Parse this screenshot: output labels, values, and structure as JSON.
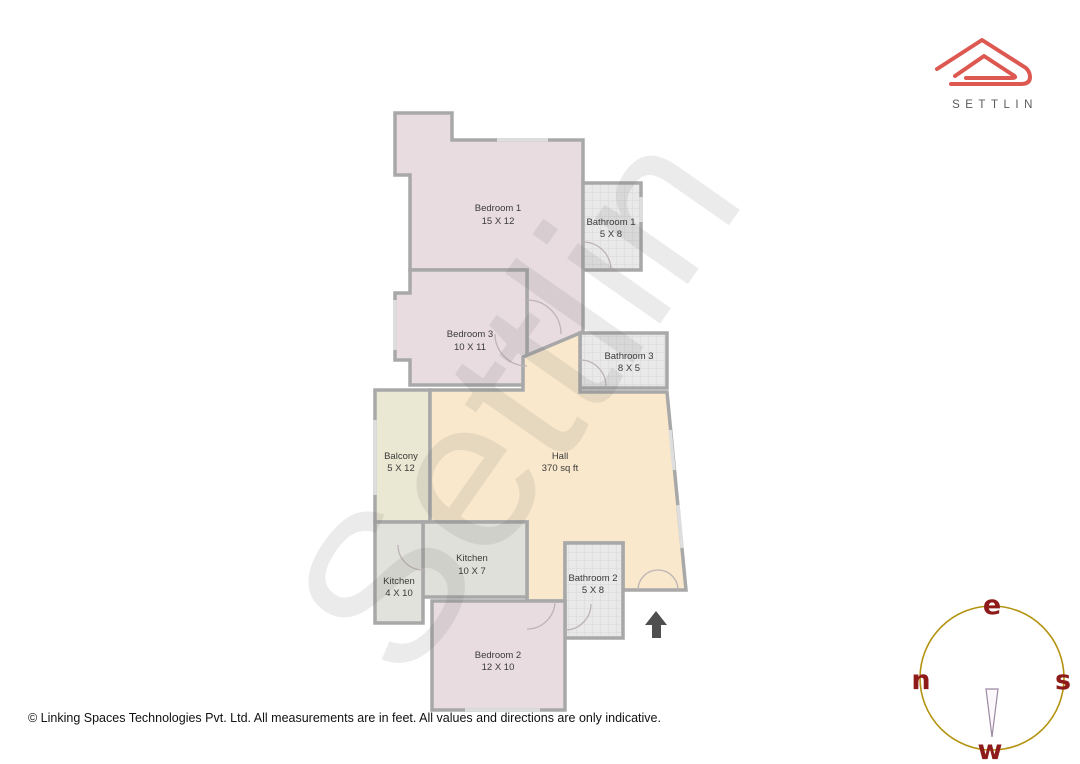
{
  "logo": {
    "brand": "SETTLIN"
  },
  "watermark": "Settlin",
  "rooms": [
    {
      "name": "Bedroom 1",
      "dims": "15 X 12"
    },
    {
      "name": "Bathroom 1",
      "dims": "5 X 8"
    },
    {
      "name": "Bedroom 3",
      "dims": "10 X 11"
    },
    {
      "name": "Bathroom 3",
      "dims": "8 X 5"
    },
    {
      "name": "Balcony",
      "dims": "5 X 12"
    },
    {
      "name": "Hall",
      "dims": "370 sq ft"
    },
    {
      "name": "Kitchen",
      "dims": "10 X 7"
    },
    {
      "name": "Kitchen",
      "dims": "4 X 10"
    },
    {
      "name": "Bathroom 2",
      "dims": "5 X 8"
    },
    {
      "name": "Bedroom 2",
      "dims": "12 X 10"
    }
  ],
  "compass": {
    "top": "e",
    "left": "n",
    "right": "s",
    "bottom": "w"
  },
  "footer": {
    "text": "© Linking Spaces Technologies Pvt. Ltd. All measurements are in feet. All values and directions are only indicative."
  },
  "colors": {
    "logo_red": "#dc5850",
    "wall_gray": "#a8a8a8",
    "bedroom_fill": "#e8dce0",
    "bathroom_fill": "#e9e9e9",
    "kitchen_fill": "#dfe0d9",
    "hall_fill": "#f9e8cc",
    "balcony_fill": "#eae7d2",
    "compass_ring": "#b3920e",
    "compass_letters": "#8e1a1a",
    "entrance_arrow": "#4f4f4f"
  }
}
